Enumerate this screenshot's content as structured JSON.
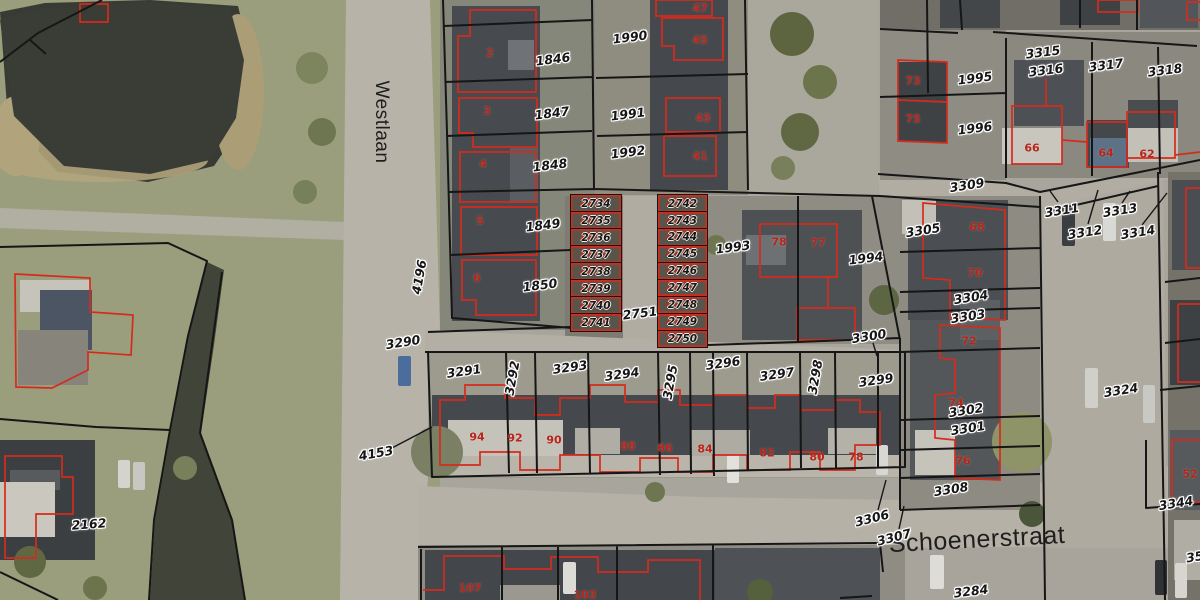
{
  "map": {
    "colors": {
      "parcel_line": "#161616",
      "building_outline": "#d52b1c",
      "parcel_label_text": "#161616",
      "house_number_text": "#bb2418",
      "water": "#383b33",
      "grass": "#9a9e7c",
      "road": "#b7b3a9",
      "roof_dark": "#43464a",
      "roof_light": "#c7c4bc"
    },
    "streets": [
      {
        "name": "Westlaan",
        "x": 381,
        "y": 122,
        "r": 90,
        "size": 19
      },
      {
        "name": "Schoenerstraat",
        "x": 977,
        "y": 540,
        "r": -3,
        "size": 25
      }
    ],
    "parcel_labels": [
      {
        "t": "1846",
        "x": 553,
        "y": 59,
        "r": -7
      },
      {
        "t": "1847",
        "x": 552,
        "y": 113,
        "r": -7
      },
      {
        "t": "1848",
        "x": 550,
        "y": 165,
        "r": -7
      },
      {
        "t": "1849",
        "x": 543,
        "y": 225,
        "r": -7
      },
      {
        "t": "1850",
        "x": 540,
        "y": 285,
        "r": -7
      },
      {
        "t": "1990",
        "x": 630,
        "y": 37,
        "r": -7
      },
      {
        "t": "1991",
        "x": 628,
        "y": 114,
        "r": -7
      },
      {
        "t": "1992",
        "x": 628,
        "y": 152,
        "r": -7
      },
      {
        "t": "2751",
        "x": 640,
        "y": 313,
        "r": -7
      },
      {
        "t": "1993",
        "x": 733,
        "y": 247,
        "r": -7
      },
      {
        "t": "1994",
        "x": 866,
        "y": 258,
        "r": -7
      },
      {
        "t": "1995",
        "x": 975,
        "y": 78,
        "r": -7
      },
      {
        "t": "1996",
        "x": 975,
        "y": 128,
        "r": -7
      },
      {
        "t": "3315",
        "x": 1043,
        "y": 52,
        "r": -7
      },
      {
        "t": "3316",
        "x": 1046,
        "y": 70,
        "r": -7
      },
      {
        "t": "3317",
        "x": 1106,
        "y": 65,
        "r": -7
      },
      {
        "t": "3318",
        "x": 1165,
        "y": 70,
        "r": -7
      },
      {
        "t": "3309",
        "x": 967,
        "y": 185,
        "r": -9
      },
      {
        "t": "3311",
        "x": 1062,
        "y": 210,
        "r": -9
      },
      {
        "t": "3312",
        "x": 1085,
        "y": 232,
        "r": -9
      },
      {
        "t": "3313",
        "x": 1120,
        "y": 210,
        "r": -9
      },
      {
        "t": "3314",
        "x": 1138,
        "y": 232,
        "r": -9
      },
      {
        "t": "3305",
        "x": 923,
        "y": 230,
        "r": -9
      },
      {
        "t": "3304",
        "x": 971,
        "y": 297,
        "r": -9
      },
      {
        "t": "3303",
        "x": 968,
        "y": 316,
        "r": -9
      },
      {
        "t": "3302",
        "x": 966,
        "y": 410,
        "r": -9
      },
      {
        "t": "3301",
        "x": 968,
        "y": 428,
        "r": -9
      },
      {
        "t": "3300",
        "x": 869,
        "y": 336,
        "r": -9
      },
      {
        "t": "3308",
        "x": 951,
        "y": 489,
        "r": -9
      },
      {
        "t": "3306",
        "x": 872,
        "y": 518,
        "r": -14
      },
      {
        "t": "3307",
        "x": 894,
        "y": 537,
        "r": -14
      },
      {
        "t": "3290",
        "x": 403,
        "y": 342,
        "r": -9
      },
      {
        "t": "4196",
        "x": 419,
        "y": 277,
        "r": -80
      },
      {
        "t": "4153",
        "x": 376,
        "y": 453,
        "r": -10
      },
      {
        "t": "2162",
        "x": 89,
        "y": 524,
        "r": -4
      },
      {
        "t": "3291",
        "x": 464,
        "y": 371,
        "r": -8
      },
      {
        "t": "3292",
        "x": 512,
        "y": 378,
        "r": -80
      },
      {
        "t": "3293",
        "x": 570,
        "y": 367,
        "r": -8
      },
      {
        "t": "3294",
        "x": 622,
        "y": 374,
        "r": -8
      },
      {
        "t": "3295",
        "x": 670,
        "y": 382,
        "r": -80
      },
      {
        "t": "3296",
        "x": 723,
        "y": 363,
        "r": -8
      },
      {
        "t": "3297",
        "x": 777,
        "y": 374,
        "r": -8
      },
      {
        "t": "3298",
        "x": 815,
        "y": 377,
        "r": -80
      },
      {
        "t": "3299",
        "x": 876,
        "y": 380,
        "r": -8
      },
      {
        "t": "3324",
        "x": 1121,
        "y": 390,
        "r": -9
      },
      {
        "t": "3344",
        "x": 1176,
        "y": 503,
        "r": -9
      },
      {
        "t": "3284",
        "x": 971,
        "y": 591,
        "r": -7
      },
      {
        "t": "359",
        "x": 1199,
        "y": 556,
        "r": -9
      }
    ],
    "house_numbers": [
      {
        "t": "2",
        "x": 490,
        "y": 53
      },
      {
        "t": "3",
        "x": 487,
        "y": 111
      },
      {
        "t": "4",
        "x": 483,
        "y": 164
      },
      {
        "t": "5",
        "x": 480,
        "y": 221
      },
      {
        "t": "6",
        "x": 477,
        "y": 278
      },
      {
        "t": "47",
        "x": 700,
        "y": 8
      },
      {
        "t": "45",
        "x": 700,
        "y": 40
      },
      {
        "t": "43",
        "x": 703,
        "y": 118
      },
      {
        "t": "41",
        "x": 700,
        "y": 156
      },
      {
        "t": "78",
        "x": 779,
        "y": 242
      },
      {
        "t": "77",
        "x": 818,
        "y": 243
      },
      {
        "t": "73",
        "x": 913,
        "y": 81
      },
      {
        "t": "75",
        "x": 913,
        "y": 119
      },
      {
        "t": "66",
        "x": 1032,
        "y": 148
      },
      {
        "t": "64",
        "x": 1106,
        "y": 153
      },
      {
        "t": "62",
        "x": 1147,
        "y": 154
      },
      {
        "t": "68",
        "x": 977,
        "y": 227
      },
      {
        "t": "70",
        "x": 975,
        "y": 273
      },
      {
        "t": "72",
        "x": 969,
        "y": 341
      },
      {
        "t": "74",
        "x": 956,
        "y": 403
      },
      {
        "t": "76",
        "x": 963,
        "y": 461
      },
      {
        "t": "94",
        "x": 477,
        "y": 437
      },
      {
        "t": "92",
        "x": 515,
        "y": 438
      },
      {
        "t": "90",
        "x": 554,
        "y": 440
      },
      {
        "t": "88",
        "x": 628,
        "y": 446
      },
      {
        "t": "86",
        "x": 665,
        "y": 448
      },
      {
        "t": "84",
        "x": 705,
        "y": 449
      },
      {
        "t": "82",
        "x": 767,
        "y": 453
      },
      {
        "t": "80",
        "x": 817,
        "y": 457
      },
      {
        "t": "78",
        "x": 856,
        "y": 457
      },
      {
        "t": "107",
        "x": 470,
        "y": 588
      },
      {
        "t": "103",
        "x": 585,
        "y": 595
      },
      {
        "t": "52",
        "x": 1190,
        "y": 474
      }
    ],
    "garage_parcels": {
      "left": [
        "2734",
        "2735",
        "2736",
        "2737",
        "2738",
        "2739",
        "2740",
        "2741"
      ],
      "right": [
        "2742",
        "2743",
        "2744",
        "2745",
        "2746",
        "2747",
        "2748",
        "2749",
        "2750"
      ]
    }
  }
}
